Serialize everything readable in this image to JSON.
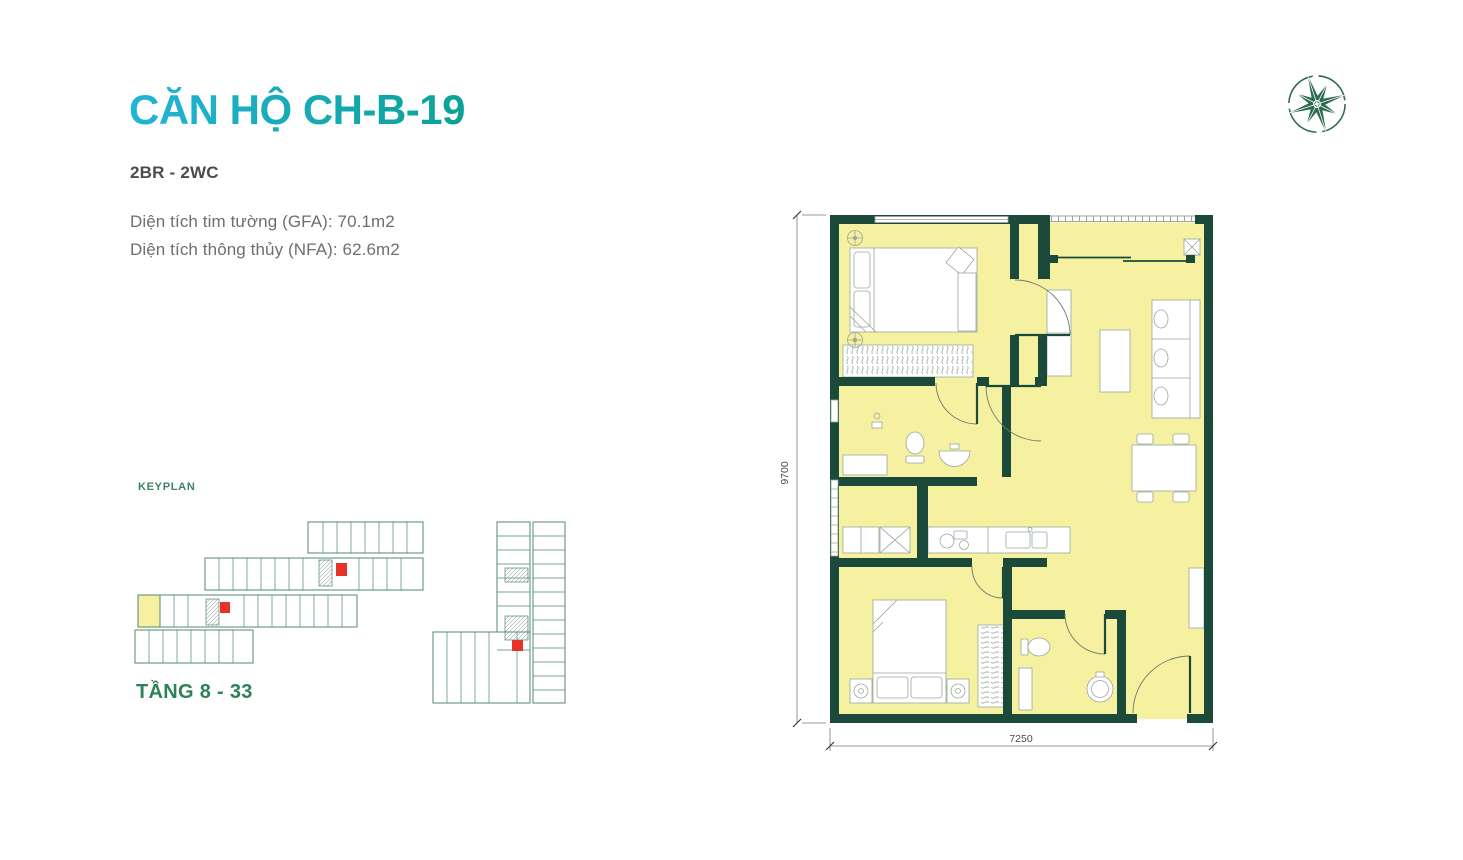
{
  "page": {
    "background": "#ffffff"
  },
  "header": {
    "title": "CĂN HỘ CH-B-19",
    "subtitle": "2BR - 2WC",
    "gfa": "Diện tích tim tường (GFA): 70.1m2",
    "nfa": "Diện tích thông thủy (NFA): 62.6m2",
    "title_gradient_start": "#23b4d6",
    "title_gradient_end": "#0aa295"
  },
  "keyplan": {
    "label": "KEYPLAN",
    "floor_range": "TẦNG 8 - 33",
    "outline_color": "#4f8a6c",
    "highlight_unit_color": "#f6f1a0",
    "core_marker_color": "#e63329"
  },
  "floorplan": {
    "width_dim": "7250",
    "height_dim": "9700",
    "wall_color": "#1b4a3a",
    "floor_color": "#f6f1a0"
  },
  "logo": {
    "icon": "compass-star-logo",
    "color": "#2e6b4f"
  }
}
